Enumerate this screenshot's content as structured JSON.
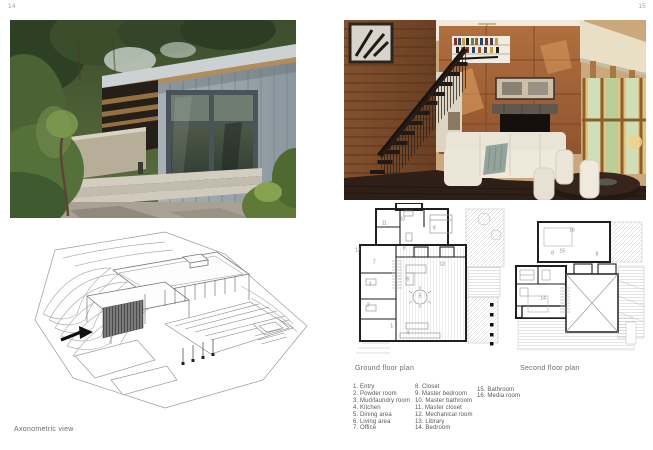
{
  "page": {
    "left_number": "14",
    "right_number": "15"
  },
  "captions": {
    "axonometric": "Axonometric view",
    "ground_floor": "Ground floor plan",
    "second_floor": "Second floor plan"
  },
  "legend": {
    "columns": [
      [
        "1. Entry",
        "2. Powder room",
        "3. Mud/laundry room",
        "4. Kitchen",
        "5. Dining area",
        "6. Living area",
        "7. Office"
      ],
      [
        "8. Closet",
        "9. Master bedroom",
        "10. Master bathroom",
        "11. Master closet",
        "12. Mechanical room",
        "13. Library",
        "14. Bedroom"
      ],
      [
        "15. Bathroom",
        "16. Media room"
      ]
    ]
  },
  "plan_labels": {
    "ground": [
      {
        "t": "1",
        "x": 27.7,
        "y": 81.8
      },
      {
        "t": "2",
        "x": 12.8,
        "y": 67.8
      },
      {
        "t": "3",
        "x": 13.9,
        "y": 53.9
      },
      {
        "t": "4",
        "x": 37.8,
        "y": 86.2
      },
      {
        "t": "5",
        "x": 45.6,
        "y": 62.0
      },
      {
        "t": "6",
        "x": 37.8,
        "y": 50.7
      },
      {
        "t": "7",
        "x": 16.6,
        "y": 39.7
      },
      {
        "t": "8",
        "x": 35.6,
        "y": 30.5
      },
      {
        "t": "9",
        "x": 54.6,
        "y": 17.3
      },
      {
        "t": "10",
        "x": 34.4,
        "y": 11.2
      },
      {
        "t": "11",
        "x": 23.0,
        "y": 13.8
      },
      {
        "t": "12",
        "x": 6.1,
        "y": 31.4
      },
      {
        "t": "13",
        "x": 59.7,
        "y": 41.0
      }
    ],
    "second": [
      {
        "t": "16",
        "x": 45.7,
        "y": 10.0
      },
      {
        "t": "8",
        "x": 31.8,
        "y": 26.9
      },
      {
        "t": "15",
        "x": 38.8,
        "y": 25.6
      },
      {
        "t": "8",
        "x": 63.6,
        "y": 27.6
      },
      {
        "t": "14",
        "x": 25.1,
        "y": 60.7
      }
    ]
  },
  "colors": {
    "corten": "#a8643c",
    "wood_wall": "#7d4e2e",
    "siding": "#97a2a8",
    "foliage": "#4c6338",
    "concrete": "#b5ac97",
    "sofa": "#e9e5d9",
    "plan_wall": "#1f1f1f"
  }
}
